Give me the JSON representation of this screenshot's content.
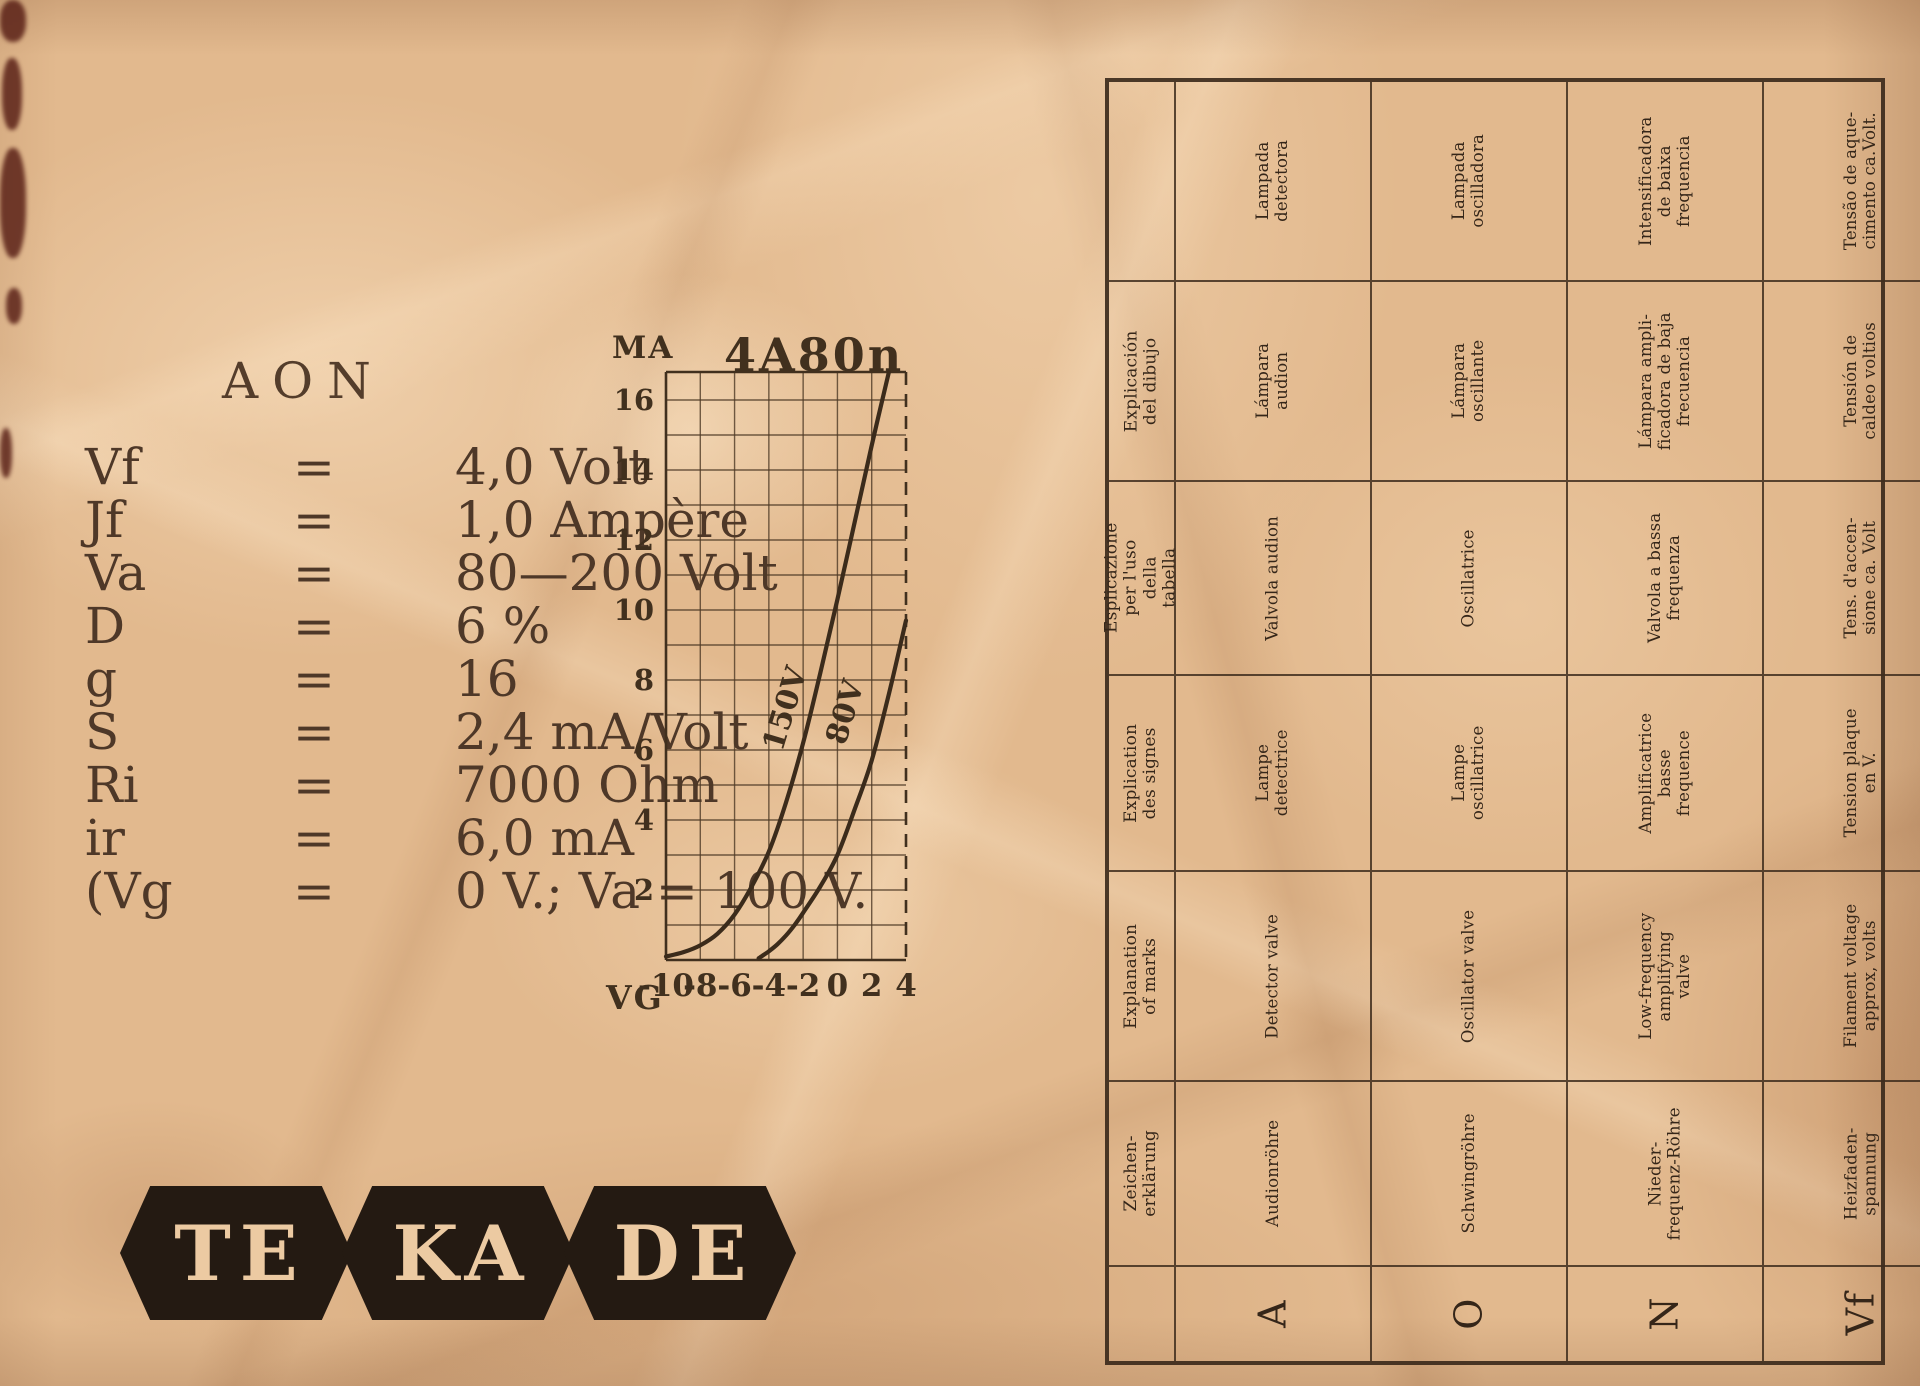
{
  "page": {
    "paper_color": "#e2b98e",
    "ink_color": "#46331f"
  },
  "specs": {
    "title": "AON",
    "rows": [
      {
        "sym": "Vf",
        "eq": "=",
        "val": "4,0 Volt"
      },
      {
        "sym": "Jf",
        "eq": "=",
        "val": "1,0 Ampère"
      },
      {
        "sym": "Va",
        "eq": "=",
        "val": "80—200 Volt"
      },
      {
        "sym": "D",
        "eq": "=",
        "val": "6 %"
      },
      {
        "sym": "g",
        "eq": "=",
        "val": "16"
      },
      {
        "sym": "S",
        "eq": "=",
        "val": "2,4 mA/Volt"
      },
      {
        "sym": "Ri",
        "eq": "=",
        "val": "7000 Ohm"
      },
      {
        "sym": "ir",
        "eq": "=",
        "val": "6,0 mA"
      },
      {
        "sym": "(Vg",
        "eq": "=",
        "val": "0 V.; Va = 100 V."
      }
    ]
  },
  "chart_data": {
    "type": "line",
    "title": "4A80n",
    "xlabel": "VG",
    "ylabel": "MA",
    "xlim": [
      -10,
      4
    ],
    "ylim": [
      0,
      16.8
    ],
    "x_ticks": [
      -10,
      -8,
      -6,
      -4,
      -2,
      0,
      2,
      4
    ],
    "y_ticks": [
      2,
      4,
      6,
      8,
      10,
      12,
      14,
      16
    ],
    "grid": "on",
    "x_grid_step": 2,
    "y_grid_step": 1,
    "series": [
      {
        "name": "150V",
        "label_at": [
          -2.5,
          7.1
        ],
        "points": [
          [
            -10,
            0.1
          ],
          [
            -9,
            0.22
          ],
          [
            -8,
            0.42
          ],
          [
            -7,
            0.75
          ],
          [
            -6,
            1.3
          ],
          [
            -5,
            2.1
          ],
          [
            -4,
            3.1
          ],
          [
            -3,
            4.5
          ],
          [
            -2,
            6.2
          ],
          [
            -1,
            8.2
          ],
          [
            0,
            10.3
          ],
          [
            1,
            12.5
          ],
          [
            2,
            14.7
          ],
          [
            3,
            16.8
          ]
        ]
      },
      {
        "name": "80V",
        "label_at": [
          1.0,
          7.0
        ],
        "points": [
          [
            -4.6,
            0.05
          ],
          [
            -4,
            0.25
          ],
          [
            -3.5,
            0.45
          ],
          [
            -3,
            0.7
          ],
          [
            -2.5,
            1.0
          ],
          [
            -2,
            1.35
          ],
          [
            -1,
            2.1
          ],
          [
            0,
            3.0
          ],
          [
            1,
            4.3
          ],
          [
            2,
            5.7
          ],
          [
            3,
            7.6
          ],
          [
            4,
            9.7
          ]
        ]
      }
    ]
  },
  "logo": {
    "letters": [
      "TE",
      "KA",
      "DE"
    ]
  },
  "table": {
    "symbols": [
      "A",
      "O",
      "N",
      "Vf",
      "Jf",
      "Va",
      "D",
      "g",
      "S",
      "Ri",
      "ir"
    ],
    "rows": [
      {
        "language": "portuguese",
        "header": "",
        "cells": [
          "Lampada\ndetectora",
          "Lampada\noscilladora",
          "Intensificadora\nde baixa\nfrequencia",
          "Tensão de aque-\ncimento ca.Volt.",
          "Corrente de\naquecimento\nca. amp.",
          "Tensão do\nanodo",
          "Amplificação\nca. %",
          "Factor de\namplificação",
          "Curvatura\nca. mA/V.",
          "Resist. interna\nca. ohmios",
          "Corrente conti-\nnua do anodo"
        ]
      },
      {
        "language": "spanish",
        "header": "Explicación\ndel dibujo",
        "cells": [
          "Lámpara\naudion",
          "Lámpara\noscillante",
          "Lámpara ampli-\nficadora de baja\nfrecuencia",
          "Tensión de\ncaldeo voltios",
          "Corriente de\ncaldeo amper.",
          "Tensión\nanodica",
          "Paso %",
          "Factor de\namplificación",
          "Verticalidad\nmilamp/Volt",
          "Resist. inter.\nOhm",
          "Corriente\ncont. anodica"
        ]
      },
      {
        "language": "italian",
        "header": "Esplicazione\nper l'uso della\ntabella",
        "cells": [
          "Valvola audion",
          "Oscillatrice",
          "Valvola a bassa\nfrequenza",
          "Tens. d'accen-\nsione ca. Volt",
          "Corr. d'accen-\nsione (valore\nmedio) ca. amp.",
          "Tensione\nanodica",
          "Intraeffetto\ncirca %",
          "Fattore d'am-\nplificazione",
          "Pendenza\nca. mA/Volt",
          "Resist. interna\ncirca ohm",
          "Corrente ano-\ndica di riposo"
        ]
      },
      {
        "language": "french",
        "header": "Explication\ndes signes",
        "cells": [
          "Lampe\ndetectrice",
          "Lampe\noscillatrice",
          "Amplificatrice\nbasse\nfrequence",
          "Tension plaque\nen V.",
          "Courant\nde chauffage\nenv. A.",
          "Tension plaque",
          "Amplification\nenv. %",
          "Facteur\nd'amplification",
          "Pente\nenv. mA/V",
          "Resist. interne\nenv. ohms",
          "Courant per-\nmanent plaque"
        ]
      },
      {
        "language": "english",
        "header": "Explanation\nof marks",
        "cells": [
          "Detector valve",
          "Oscillator valve",
          "Low-frequency\namplifying\nvalve",
          "Filament voltage\napprox, volts",
          "Filament\ncurrent approx.\namps.",
          "Plate voltage",
          "Transit.emission\napprox. %",
          "Amplifying\nfactor",
          "Steepness\napprox.m.amps/v.",
          "Impedance\napprox. ohm",
          "H. T. current\napprox. m. amps."
        ]
      },
      {
        "language": "german",
        "header": "Zeichen-\nerklärung",
        "cells": [
          "Audionröhre",
          "Schwingröhre",
          "Nieder-\nfrequenz-Röhre",
          "Heizfaden-\nspannung",
          "Heizfaden-\nstrom",
          "Anoden-\nspannung",
          "Durchgriff",
          "Verstärkungs-\nFaktor",
          "Steilheit",
          "Innen-\nwiderstand",
          "Anoden-\nruhestrom"
        ]
      }
    ]
  }
}
